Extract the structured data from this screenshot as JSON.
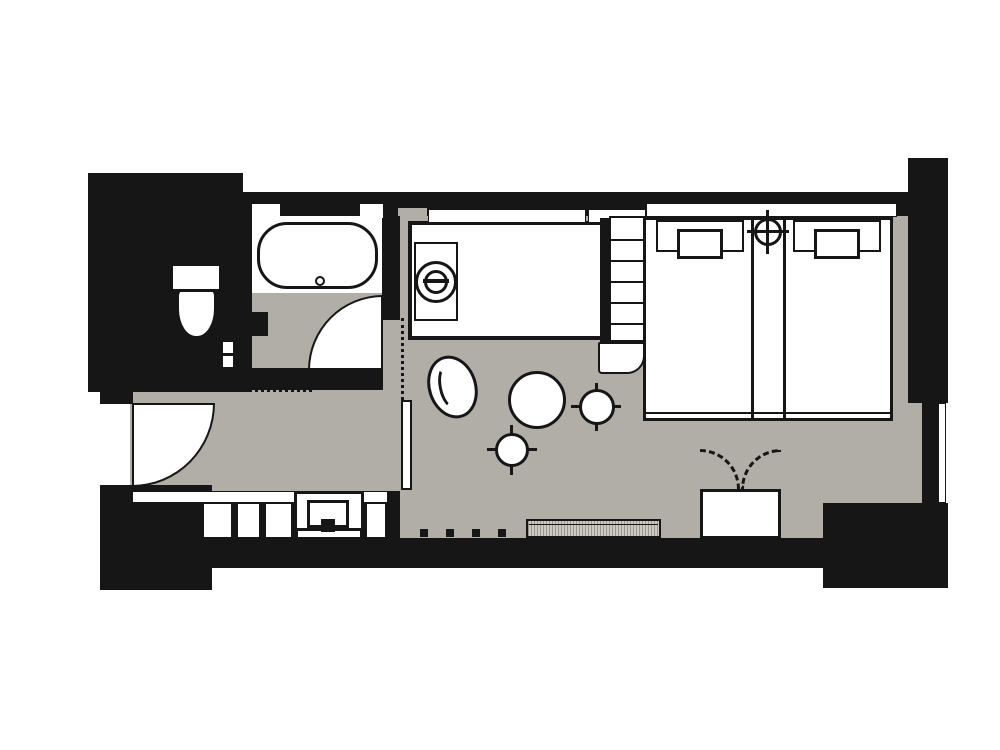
{
  "canvas": {
    "width": 1000,
    "height": 750
  },
  "colors": {
    "wall": "#161616",
    "floor": "#b1ada7",
    "fixture_fill": "#ffffff",
    "bench_hatch_dark": "#9a968f",
    "bench_hatch_light": "#cdc9c3",
    "background": "#ffffff"
  },
  "floor_plan": {
    "type": "hotel-guestroom-floor-plan",
    "rooms": [
      "bathroom",
      "toilet-room",
      "entry-hall",
      "bedroom-living-area",
      "closet"
    ],
    "fixtures": [
      "bathtub",
      "bathtub-drain",
      "bathtub-faucet",
      "toilet",
      "vanity-counter",
      "sink-basin",
      "faucet",
      "shelf-ladder",
      "closet-shelves",
      "safe-unit",
      "sliding-partition-panel",
      "window-glazing"
    ],
    "furniture": {
      "beds": 2,
      "pillows": 2,
      "round_nightstand": 1,
      "lounge_chair": 1,
      "round_table": 1,
      "stools": 2,
      "window_bench": 1,
      "luggage_rack": 1
    },
    "doors": [
      "entry-swing-door",
      "bathroom-swing-door",
      "toilet-pocket-door"
    ],
    "annotations": [
      "dotted-threshold-line",
      "dotted-partition-line",
      "dashed-luggage-rack-lids",
      "window-mullion-ticks"
    ]
  }
}
